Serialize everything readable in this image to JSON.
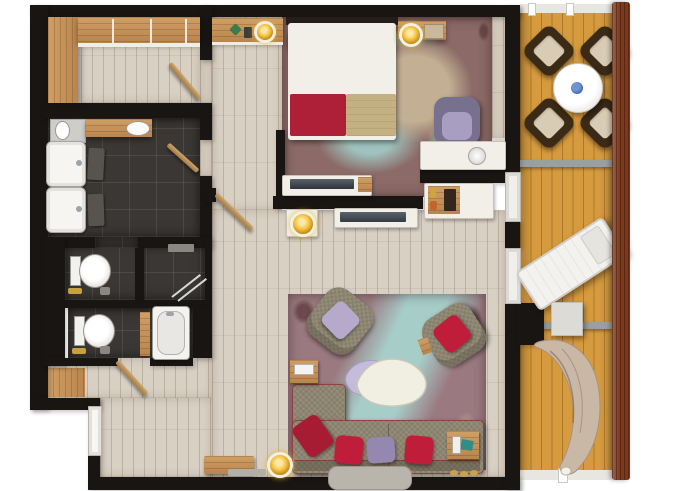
{
  "scene": {
    "kind": "apartment-floor-plan-top-view",
    "rooms": [
      {
        "id": "entry-closet",
        "furniture": [
          "wardrobe-left",
          "wardrobe-top",
          "swing-door"
        ]
      },
      {
        "id": "bathroom",
        "furniture": [
          "wood-vanity",
          "vessel-basin",
          "mirror-counter",
          "sink-1",
          "sink-2",
          "bath-mat-1",
          "bath-mat-2",
          "swing-door"
        ]
      },
      {
        "id": "wc-shower-room",
        "furniture": [
          "toilet",
          "shower-glass",
          "towel-shelf",
          "toiletry-items"
        ]
      },
      {
        "id": "wc-bathtub-room",
        "furniture": [
          "toilet",
          "bathtub",
          "wood-shelf",
          "swing-door"
        ]
      },
      {
        "id": "hallway",
        "furniture": [
          "entry-door",
          "entry-wood-mat",
          "console-with-lamp",
          "swing-door",
          "wood-bench",
          "doormat",
          "floor-lamp"
        ]
      },
      {
        "id": "bedroom",
        "furniture": [
          "double-bed",
          "purple-pillows",
          "red-pillows",
          "red-tan-throw",
          "nightstand-shelf-left",
          "nightstand-shelf-right",
          "gold-lamp-left",
          "gold-lamp-right",
          "area-rug",
          "armchair",
          "desk",
          "decor-bowl",
          "tv-console",
          "tv"
        ]
      },
      {
        "id": "living-room",
        "furniture": [
          "area-rug",
          "armchair-lilac-pillow",
          "armchair-red-pillow",
          "coffee-table-organic",
          "lilac-tray",
          "l-shaped-sofa",
          "red-cushions",
          "purple-cushion",
          "ottoman-bench",
          "side-table-left",
          "side-table-right",
          "tv-console",
          "tv",
          "table-lamp",
          "minibar-cabinet",
          "slippers"
        ]
      },
      {
        "id": "balcony",
        "furniture": [
          "round-dining-table",
          "blue-bowl",
          "dining-chair-nw",
          "dining-chair-ne",
          "dining-chair-sw",
          "dining-chair-se",
          "sun-lounger",
          "square-side-table",
          "covered-hanging-lounger",
          "deck-divider-1",
          "deck-divider-2",
          "railing"
        ]
      }
    ]
  },
  "colors": {
    "wall": "#181512",
    "plank": "#d9d0c4",
    "tile": "#3a3734",
    "deck": "#d79b3f",
    "railing": "#7c3a1d",
    "white_furniture": "#f2efe9",
    "sofa": "#8d8570",
    "chair_brown": "#3a2a16",
    "cream_cushion": "#d9ccb5",
    "rug_bedroom": "#8b6a67",
    "rug_living": "#9a7a80",
    "rug_teal": "#a3d2cd",
    "bed_red": "#ae2038",
    "bed_tan": "#c3b183",
    "pillow_purple": "#9b8cb4",
    "pillow_red": "#c01d3a",
    "lilac": "#c5bcdc",
    "gold": "#e8b32a",
    "table_blue": "#3a66b0",
    "divider_gray": "#9aa0a2"
  }
}
